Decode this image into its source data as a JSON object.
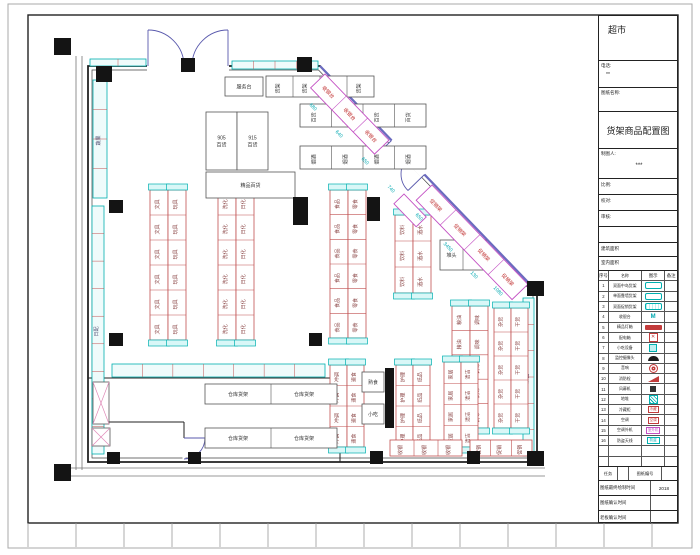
{
  "title_block": {
    "store_name": "超市",
    "phone_label": "电话:",
    "phone_value": "**",
    "drawing_name_label": "图纸名称:",
    "drawing_title": "货架商品配置图",
    "drafter_label": "制图人:",
    "drafter_value": "***",
    "scale_label": "比例:",
    "check_label": "校对:",
    "review_label": "审核:",
    "building_area_label": "建筑面积",
    "interior_area_label": "室内面积",
    "legend": {
      "headers": [
        "序号",
        "名称",
        "图示",
        "备注"
      ],
      "rows": [
        {
          "no": "1",
          "name": "双面中岛货架",
          "sym": "shelf",
          "symtext": ""
        },
        {
          "no": "2",
          "name": "单面靠墙货架",
          "sym": "shelf",
          "symtext": ""
        },
        {
          "no": "3",
          "name": "双面促销货架",
          "sym": "shelf2",
          "symtext": ""
        },
        {
          "no": "4",
          "name": "收银台",
          "sym": "m",
          "symtext": "M"
        },
        {
          "no": "5",
          "name": "精品灯箱",
          "sym": "redbar",
          "symtext": ""
        },
        {
          "no": "6",
          "name": "配电箱",
          "sym": "redhatch",
          "symtext": "✕"
        },
        {
          "no": "7",
          "name": "小吃设备",
          "sym": "cyanglyph",
          "symtext": ""
        },
        {
          "no": "8",
          "name": "监控摄像头",
          "sym": "dome",
          "symtext": ""
        },
        {
          "no": "9",
          "name": "音响",
          "sym": "redcircle",
          "symtext": ""
        },
        {
          "no": "10",
          "name": "消防栓",
          "sym": "redflag",
          "symtext": ""
        },
        {
          "no": "11",
          "name": "风幕机",
          "sym": "darksq",
          "symtext": ""
        },
        {
          "no": "12",
          "name": "地堆",
          "sym": "cyanhatch",
          "symtext": ""
        },
        {
          "no": "13",
          "name": "冷藏柜",
          "sym": "redboxtext",
          "symtext": "冷藏"
        },
        {
          "no": "14",
          "name": "空调",
          "sym": "redbox",
          "symtext": "空调"
        },
        {
          "no": "15",
          "name": "空调外机",
          "sym": "magbox",
          "symtext": "室外机"
        },
        {
          "no": "16",
          "name": "防盗天线",
          "sym": "cyanbox",
          "symtext": "防盗"
        },
        {
          "no": "",
          "name": "",
          "sym": "none",
          "symtext": ""
        },
        {
          "no": "",
          "name": "",
          "sym": "none",
          "symtext": ""
        }
      ]
    },
    "task_label": "任务",
    "drawing_no_label": "图纸编号",
    "final_time_label": "图纸最终绘制时间",
    "final_time_value": "2018",
    "confirm_time_label": "图纸确认时间",
    "confirm_time_value": "",
    "boss_time_label": "老板确认时间",
    "boss_time_value": ""
  },
  "plan": {
    "colors": {
      "cyan": "#00b0b0",
      "cyan_fill": "#effbfb",
      "cap_fill": "#d9f7f7",
      "red": "#c05050",
      "dark": "#555555",
      "magenta": "#c34fc3",
      "pink": "#e08ab8",
      "purple": "#6b6bc0",
      "dim": "#00a8b0"
    },
    "walls": [
      {
        "d": "M88,66 L320,66 L537,291.5 L537,462 L88,462 Z",
        "w": 1.8,
        "c": "#222"
      },
      {
        "d": "M92,70 L318.5,70 L533,293 L533,458 L92,458 Z",
        "w": 0.7,
        "c": "#444"
      },
      {
        "d": "M76,56 L76,470",
        "w": 0.8,
        "c": "#777"
      },
      {
        "d": "M82,56 L82,470",
        "w": 0.8,
        "c": "#777"
      },
      {
        "d": "M62,468 L545,468",
        "w": 0.8,
        "c": "#777"
      },
      {
        "d": "M62,476 L545,476",
        "w": 0.8,
        "c": "#777"
      },
      {
        "d": "M88,378 L340,378",
        "w": 1,
        "c": "#222"
      },
      {
        "d": "M340,378 L340,462",
        "w": 1,
        "c": "#222"
      },
      {
        "d": "M92,422 L184,422",
        "w": 1,
        "c": "#222"
      },
      {
        "d": "M184,422 L184,438",
        "w": 1,
        "c": "#222"
      },
      {
        "d": "M320,66 L537,291.5",
        "w": 2.2,
        "c": "#6b6bc0"
      }
    ],
    "gaps": [
      {
        "d": "M147,66 L229,66",
        "w": 9
      },
      {
        "d": "M391.5,140.5 L424.5,174.5",
        "w": 9
      },
      {
        "d": "M184,439 L184,459",
        "w": 3
      }
    ],
    "doors": [
      {
        "d": "M148,66 L148,30"
      },
      {
        "d": "M148,30 A36,36 0 0 1 184,66"
      },
      {
        "d": "M228,66 L228,30"
      },
      {
        "d": "M228,30 A36,36 0 0 0 192,66"
      },
      {
        "d": "M391.5,140.5 L375,156.5"
      },
      {
        "d": "M375,156.5 A23,23 0 0 0 408,157.5"
      },
      {
        "d": "M424.5,174.5 L408,190.5"
      },
      {
        "d": "M408,190.5 A23,23 0 0 1 408,157.5"
      },
      {
        "d": "M184,438 L205,438"
      },
      {
        "d": "M205,438 A21,21 0 0 1 184,459"
      }
    ],
    "wall_shelves": [
      {
        "x": 232,
        "y": 61,
        "w": 86,
        "h": 8,
        "c": 4,
        "t": ""
      },
      {
        "x": 90,
        "y": 59,
        "w": 56,
        "h": 7,
        "c": 2,
        "t": ""
      },
      {
        "x": 93,
        "y": 80,
        "w": 14,
        "h": 118,
        "c": 4,
        "t": "蔬果"
      },
      {
        "x": 92,
        "y": 206,
        "w": 12,
        "h": 248,
        "c": 9,
        "t": "日配"
      },
      {
        "x": 523,
        "y": 298,
        "w": 11,
        "h": 158,
        "c": 6,
        "t": "米面"
      },
      {
        "x": 112,
        "y": 364,
        "w": 213,
        "h": 13,
        "c": 7,
        "t": ""
      }
    ],
    "gondolas": [
      {
        "x": 266,
        "y": 76,
        "w": 108,
        "h": 21,
        "c": 4,
        "o": "h",
        "t": "货架",
        "s": "k",
        "cap": false
      },
      {
        "x": 300,
        "y": 104,
        "w": 126,
        "h": 23,
        "c": 4,
        "o": "h",
        "t": "百货",
        "s": "k",
        "cap": false
      },
      {
        "x": 300,
        "y": 146,
        "w": 126,
        "h": 23,
        "c": 4,
        "o": "h",
        "t": "烟酒",
        "s": "k",
        "cap": false
      },
      {
        "x": 150,
        "y": 190,
        "w": 18,
        "h": 150,
        "c": 6,
        "o": "v",
        "t": "文具",
        "s": "r",
        "cap": true
      },
      {
        "x": 168,
        "y": 190,
        "w": 18,
        "h": 150,
        "c": 6,
        "o": "v",
        "t": "玩具",
        "s": "r",
        "cap": true
      },
      {
        "x": 218,
        "y": 190,
        "w": 18,
        "h": 150,
        "c": 6,
        "o": "v",
        "t": "洗化",
        "s": "r",
        "cap": true
      },
      {
        "x": 236,
        "y": 190,
        "w": 18,
        "h": 150,
        "c": 6,
        "o": "v",
        "t": "日化",
        "s": "r",
        "cap": true
      },
      {
        "x": 330,
        "y": 190,
        "w": 18,
        "h": 148,
        "c": 6,
        "o": "v",
        "t": "食品",
        "s": "r",
        "cap": true
      },
      {
        "x": 348,
        "y": 190,
        "w": 18,
        "h": 148,
        "c": 6,
        "o": "v",
        "t": "零食",
        "s": "r",
        "cap": true
      },
      {
        "x": 395,
        "y": 215,
        "w": 18,
        "h": 78,
        "c": 3,
        "o": "v",
        "t": "饮料",
        "s": "r",
        "cap": true
      },
      {
        "x": 413,
        "y": 215,
        "w": 18,
        "h": 78,
        "c": 3,
        "o": "v",
        "t": "酒水",
        "s": "r",
        "cap": true
      },
      {
        "x": 452,
        "y": 306,
        "w": 18,
        "h": 122,
        "c": 5,
        "o": "v",
        "t": "粮油",
        "s": "r",
        "cap": true
      },
      {
        "x": 470,
        "y": 306,
        "w": 18,
        "h": 122,
        "c": 5,
        "o": "v",
        "t": "调味",
        "s": "r",
        "cap": true
      },
      {
        "x": 494,
        "y": 308,
        "w": 17,
        "h": 120,
        "c": 5,
        "o": "v",
        "t": "杂货",
        "s": "r",
        "cap": true
      },
      {
        "x": 511,
        "y": 308,
        "w": 17,
        "h": 120,
        "c": 5,
        "o": "v",
        "t": "干货",
        "s": "r",
        "cap": true
      },
      {
        "x": 330,
        "y": 365,
        "w": 17,
        "h": 82,
        "c": 4,
        "o": "v",
        "t": "冲调",
        "s": "r",
        "cap": true
      },
      {
        "x": 347,
        "y": 365,
        "w": 17,
        "h": 82,
        "c": 4,
        "o": "v",
        "t": "速食",
        "s": "r",
        "cap": true
      },
      {
        "x": 396,
        "y": 365,
        "w": 17,
        "h": 82,
        "c": 4,
        "o": "v",
        "t": "护理",
        "s": "r",
        "cap": true
      },
      {
        "x": 413,
        "y": 365,
        "w": 17,
        "h": 82,
        "c": 4,
        "o": "v",
        "t": "纸品",
        "s": "r",
        "cap": true
      },
      {
        "x": 444,
        "y": 362,
        "w": 17,
        "h": 85,
        "c": 4,
        "o": "v",
        "t": "家居",
        "s": "r",
        "cap": true
      },
      {
        "x": 461,
        "y": 362,
        "w": 17,
        "h": 85,
        "c": 4,
        "o": "v",
        "t": "清洁",
        "s": "r",
        "cap": true
      },
      {
        "x": 390,
        "y": 440,
        "w": 72,
        "h": 16,
        "c": 3,
        "o": "h",
        "t": "收银",
        "s": "r",
        "cap": false
      },
      {
        "x": 470,
        "y": 440,
        "w": 62,
        "h": 16,
        "c": 3,
        "o": "h",
        "t": "促销",
        "s": "r",
        "cap": false
      },
      {
        "x": 205,
        "y": 384,
        "w": 132,
        "h": 20,
        "c": 2,
        "o": "h",
        "t": "仓库货架",
        "s": "k",
        "cap": false,
        "hz": true
      },
      {
        "x": 205,
        "y": 428,
        "w": 132,
        "h": 20,
        "c": 2,
        "o": "h",
        "t": "仓库货架",
        "s": "k",
        "cap": false,
        "hz": true
      },
      {
        "x": 440,
        "y": 240,
        "w": 46,
        "h": 30,
        "c": 2,
        "o": "h",
        "t": "堆头",
        "s": "k",
        "cap": false,
        "hz": true
      }
    ],
    "boxes": [
      {
        "x": 225,
        "y": 77,
        "w": 38,
        "h": 19,
        "t": "服务台",
        "diag": false
      },
      {
        "x": 206,
        "y": 112,
        "w": 31,
        "h": 58,
        "t": "905 百货",
        "diag": false
      },
      {
        "x": 237,
        "y": 112,
        "w": 31,
        "h": 58,
        "t": "915 百货",
        "diag": false
      },
      {
        "x": 206,
        "y": 172,
        "w": 89,
        "h": 26,
        "t": "精品百货",
        "diag": false
      },
      {
        "x": 362,
        "y": 372,
        "w": 22,
        "h": 20,
        "t": "熟食",
        "diag": false
      },
      {
        "x": 362,
        "y": 404,
        "w": 22,
        "h": 20,
        "t": "小吃",
        "diag": false
      },
      {
        "x": 93,
        "y": 382,
        "w": 16,
        "h": 42,
        "t": "",
        "diag": true
      },
      {
        "x": 92,
        "y": 428,
        "w": 18,
        "h": 18,
        "t": "",
        "diag": true
      }
    ],
    "diag_strips": [
      {
        "x": 325,
        "y": 74,
        "len": 92,
        "h": 20,
        "c": 3,
        "t": "收银台"
      },
      {
        "x": 432,
        "y": 185,
        "len": 138,
        "h": 22,
        "c": 4,
        "t": "促销架"
      },
      {
        "x": 404,
        "y": 194,
        "len": 32,
        "h": 14,
        "c": 1,
        "t": ""
      }
    ],
    "diag_angle": 46,
    "columns": [
      [
        54,
        38,
        17,
        17
      ],
      [
        96,
        66,
        16,
        16
      ],
      [
        181,
        58,
        14,
        14
      ],
      [
        297,
        57,
        15,
        15
      ],
      [
        109,
        200,
        14,
        13
      ],
      [
        109,
        333,
        14,
        13
      ],
      [
        107,
        452,
        13,
        12
      ],
      [
        54,
        464,
        17,
        17
      ],
      [
        188,
        452,
        13,
        12
      ],
      [
        293,
        197,
        15,
        28
      ],
      [
        309,
        333,
        13,
        13
      ],
      [
        367,
        197,
        13,
        24
      ],
      [
        527,
        281,
        17,
        15
      ],
      [
        527,
        451,
        17,
        15
      ],
      [
        370,
        451,
        13,
        13
      ],
      [
        467,
        451,
        13,
        13
      ],
      [
        385,
        368,
        9,
        60
      ]
    ],
    "dims": [
      [
        312,
        108,
        "680"
      ],
      [
        338,
        135,
        "640"
      ],
      [
        364,
        162,
        "650"
      ],
      [
        390,
        190,
        "740"
      ],
      [
        418,
        218,
        "650"
      ],
      [
        447,
        248,
        "3450"
      ],
      [
        473,
        276,
        "130"
      ],
      [
        497,
        292,
        "1080"
      ]
    ]
  }
}
